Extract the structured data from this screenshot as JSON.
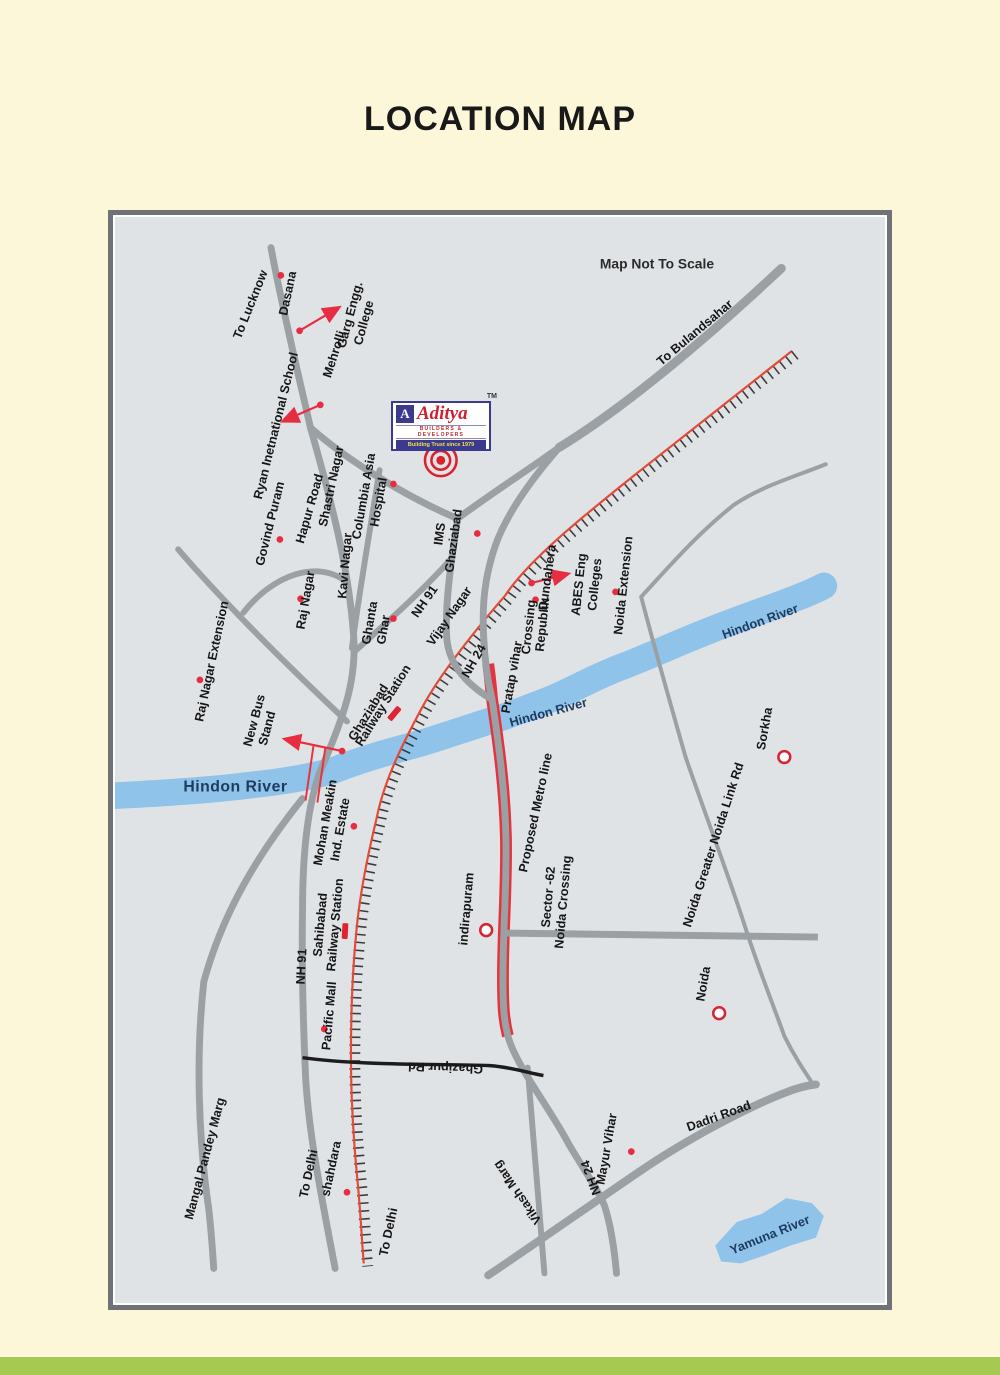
{
  "page": {
    "title": "LOCATION MAP",
    "background": "#fcf7d8",
    "bottom_bar_color": "#a6c951"
  },
  "logo": {
    "monogram": "A",
    "brand": "Aditya",
    "tm": "TM",
    "line1": "BUILDERS & DEVELOPERS",
    "line2": "Building Trust since 1979"
  },
  "colors": {
    "road_gray": "#9aa0a3",
    "black_road": "#1c1c1c",
    "railway_red": "#e14b38",
    "river_blue": "#8fc3e9",
    "river_text": "#1d3a5f",
    "marker_red": "#e62e40",
    "logo_navy": "#3b3a8c",
    "logo_red": "#cf2030"
  },
  "map": {
    "labels": [
      {
        "text": "Map Not To Scale"
      },
      {
        "text": "To Lucknow"
      },
      {
        "text": "Dasana"
      },
      {
        "text": "Garg Engg."
      },
      {
        "text": "College"
      },
      {
        "text": "Mehrolli"
      },
      {
        "text": "Ryan Inetnational School"
      },
      {
        "text": "Govind Puram"
      },
      {
        "text": "Hapur Road"
      },
      {
        "text": "Shastri Nagar"
      },
      {
        "text": "Columbia Asia"
      },
      {
        "text": "Hospital"
      },
      {
        "text": "Kavi Nagar"
      },
      {
        "text": "Raj Nagar"
      },
      {
        "text": "Raj Nagar Extension"
      },
      {
        "text": "Ghanta"
      },
      {
        "text": "Ghar"
      },
      {
        "text": "IMS"
      },
      {
        "text": "Ghaziabad"
      },
      {
        "text": "NH 91"
      },
      {
        "text": "Vijay Nagar"
      },
      {
        "text": "To Bulandsahar"
      },
      {
        "text": "Dundahera"
      },
      {
        "text": "Crossing"
      },
      {
        "text": "Republik"
      },
      {
        "text": "ABES Eng"
      },
      {
        "text": "Colleges"
      },
      {
        "text": "Noida Extension"
      },
      {
        "text": "NH 24"
      },
      {
        "text": "Pratap vihar"
      },
      {
        "text": "Hindon River"
      },
      {
        "text": "Hindon River"
      },
      {
        "text": "Hindon River"
      },
      {
        "text": "Ghaziabad"
      },
      {
        "text": "Railway Station"
      },
      {
        "text": "New Bus"
      },
      {
        "text": "Stand"
      },
      {
        "text": "Mohan Meakin"
      },
      {
        "text": "Ind. Estate"
      },
      {
        "text": "Proposed Metro line"
      },
      {
        "text": "Sector -62"
      },
      {
        "text": "Noida Crossing"
      },
      {
        "text": "indirapuram"
      },
      {
        "text": "NH 91"
      },
      {
        "text": "Sahibabad"
      },
      {
        "text": "Railway Station"
      },
      {
        "text": "Pacific Mall"
      },
      {
        "text": "Ghazipur Rd"
      },
      {
        "text": "Mangal Pandey Marg"
      },
      {
        "text": "To Delhi"
      },
      {
        "text": "shahdara"
      },
      {
        "text": "To Delhi"
      },
      {
        "text": "Vikash Marg"
      },
      {
        "text": "NH 24"
      },
      {
        "text": "Mayur Vihar"
      },
      {
        "text": "Dadri Road"
      },
      {
        "text": "Noida Greater Noida Link Rd"
      },
      {
        "text": "Noida"
      },
      {
        "text": "Sorkha"
      },
      {
        "text": "Yamuna River"
      }
    ]
  }
}
